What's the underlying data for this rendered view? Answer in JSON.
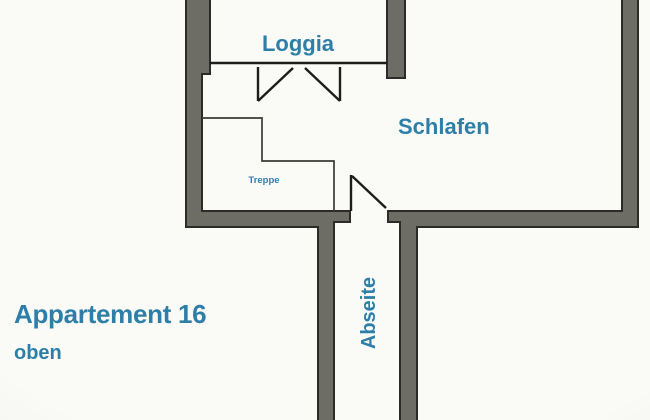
{
  "plan": {
    "title": "Appartement 16",
    "subtitle": "oben",
    "labels": {
      "loggia": "Loggia",
      "schlafen": "Schlafen",
      "treppe": "Treppe",
      "abseite": "Abseite"
    }
  },
  "colors": {
    "background": "#fafaf7",
    "wall_fill": "#6d6d66",
    "wall_outline": "#2b2b27",
    "line": "#1d1d1b",
    "label_teal": "#2e7fa8"
  }
}
